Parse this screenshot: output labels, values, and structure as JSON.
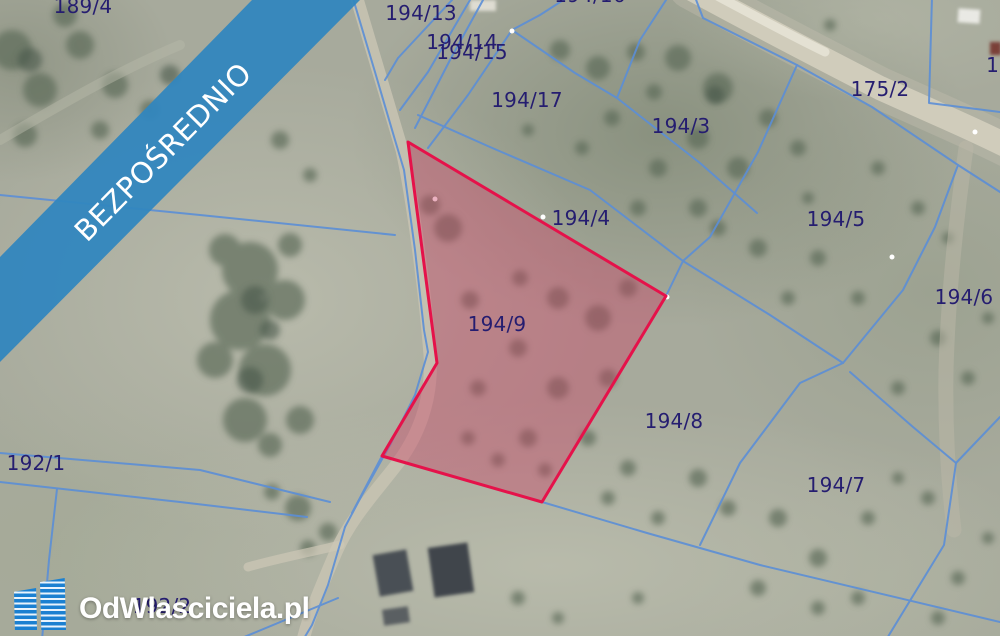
{
  "map": {
    "description": "aerial cadastral map of land parcels",
    "parcel_labels": [
      "189/4",
      "194/13",
      "194/14",
      "194/15",
      "194/16",
      "194/17",
      "194/3",
      "175/2",
      "11",
      "194/4",
      "194/5",
      "194/6",
      "194/9",
      "194/8",
      "194/7",
      "192/1",
      "192/2"
    ],
    "highlighted_parcel": {
      "number": "194/9",
      "outline_color": "#e5124a",
      "fill_color": "#cd3e63"
    },
    "boundary_line_color": "#5b8ed6",
    "label_color": "#251d70"
  },
  "banner": {
    "text": "BEZPOŚREDNIO",
    "background_color": "#3186be",
    "text_color": "#ffffff"
  },
  "logo": {
    "text": "OdWlasciciela.pl",
    "icon": "buildings-icon",
    "icon_color": "#1b80d1",
    "text_color": "#ffffff"
  }
}
